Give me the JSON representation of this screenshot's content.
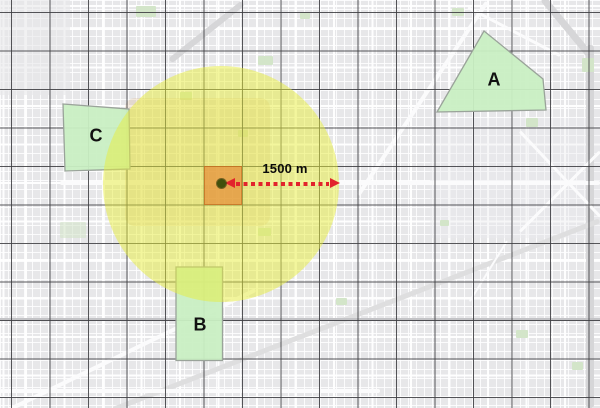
{
  "figure": {
    "title": "buffer-distance-map",
    "distance_label": "1500 m",
    "buffer": {
      "radius_label": "1500 m",
      "shape": "circle"
    },
    "zones": [
      {
        "id": "A",
        "label": "A"
      },
      {
        "id": "B",
        "label": "B"
      },
      {
        "id": "C",
        "label": "C"
      }
    ],
    "colors": {
      "buffer_fill": "#e8ee3c",
      "zone_fill": "#c9efc3",
      "zone_border": "#9aa39a",
      "center_cell_fill": "#e47d2a",
      "center_point": "#41500c",
      "arrow_red": "#e2242c",
      "grid_line": "#3e3e42",
      "map_base": "#e9e9ea",
      "park_green": "#d3e5c9",
      "label_text": "#111111"
    }
  }
}
